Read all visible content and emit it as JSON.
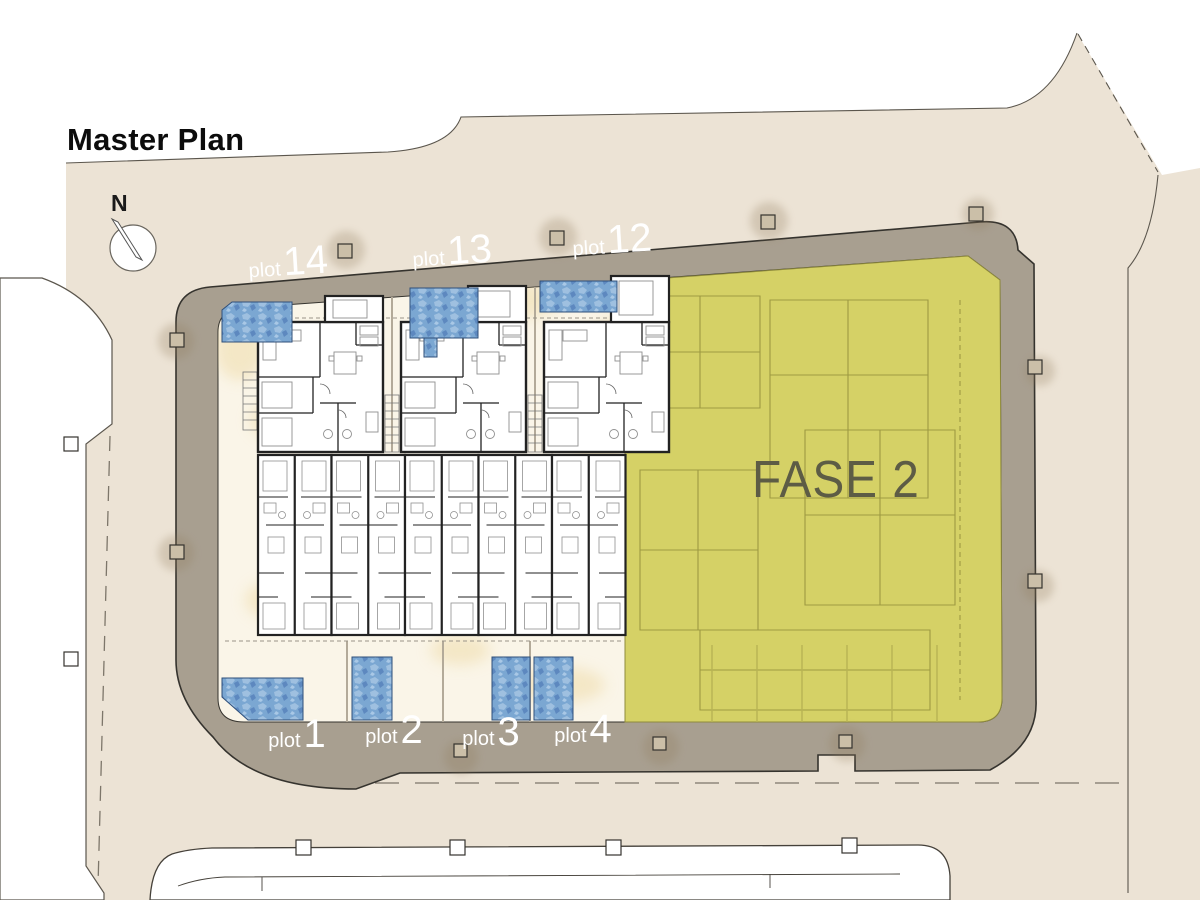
{
  "title": "Master Plan",
  "compass": {
    "label": "N"
  },
  "phase": {
    "label": "FASE 2"
  },
  "plots": {
    "top": [
      {
        "word": "plot",
        "num": "14"
      },
      {
        "word": "plot",
        "num": "13"
      },
      {
        "word": "plot",
        "num": "12"
      }
    ],
    "bottom": [
      {
        "word": "plot",
        "num": "1"
      },
      {
        "word": "plot",
        "num": "2"
      },
      {
        "word": "plot",
        "num": "3"
      },
      {
        "word": "plot",
        "num": "4"
      }
    ]
  },
  "colors": {
    "land": "#ece3d5",
    "sidewalk": "#a89f90",
    "yard": "#faf5e8",
    "phase_overlay": "#d5d166",
    "phase_text": "#5d5c45",
    "pool": "#7ba7d2",
    "label_text": "#ffffff"
  }
}
